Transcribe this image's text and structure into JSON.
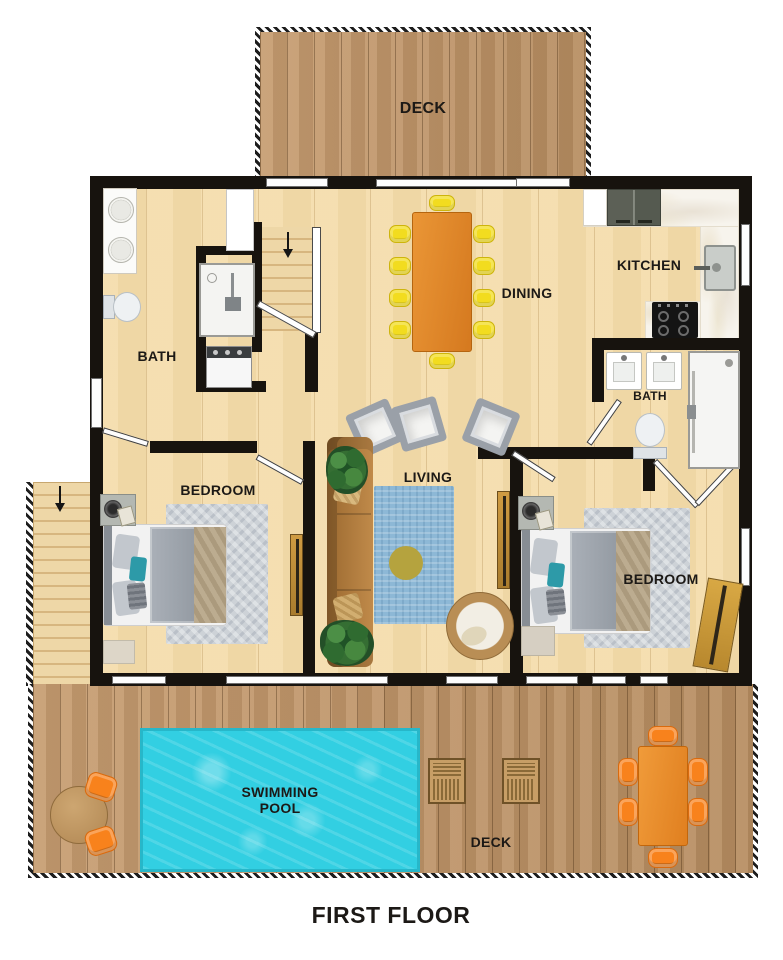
{
  "title": "FIRST FLOOR",
  "labels": {
    "deck_top": "DECK",
    "kitchen": "KITCHEN",
    "dining": "DINING",
    "bath_left": "BATH",
    "bath_right": "BATH",
    "living": "LIVING",
    "bedroom_left": "BEDROOM",
    "bedroom_right": "BEDROOM",
    "pool": "SWIMMING POOL",
    "deck_bottom": "DECK"
  },
  "colors": {
    "wall": "#17130e",
    "floor_wood": "#f4dba8",
    "deck_wood": "#c09167",
    "pool_water": "#32cfe2",
    "marble": "#f7f4ed",
    "dining_table": "#e0862b",
    "chair_yellow": "#f2dc1f",
    "chair_orange": "#f8821c",
    "sofa_brown": "#b1793f",
    "rug_blue": "#8db8d6",
    "rug_gray": "#cdd2d7",
    "pillow_teal": "#2d9aa8"
  }
}
